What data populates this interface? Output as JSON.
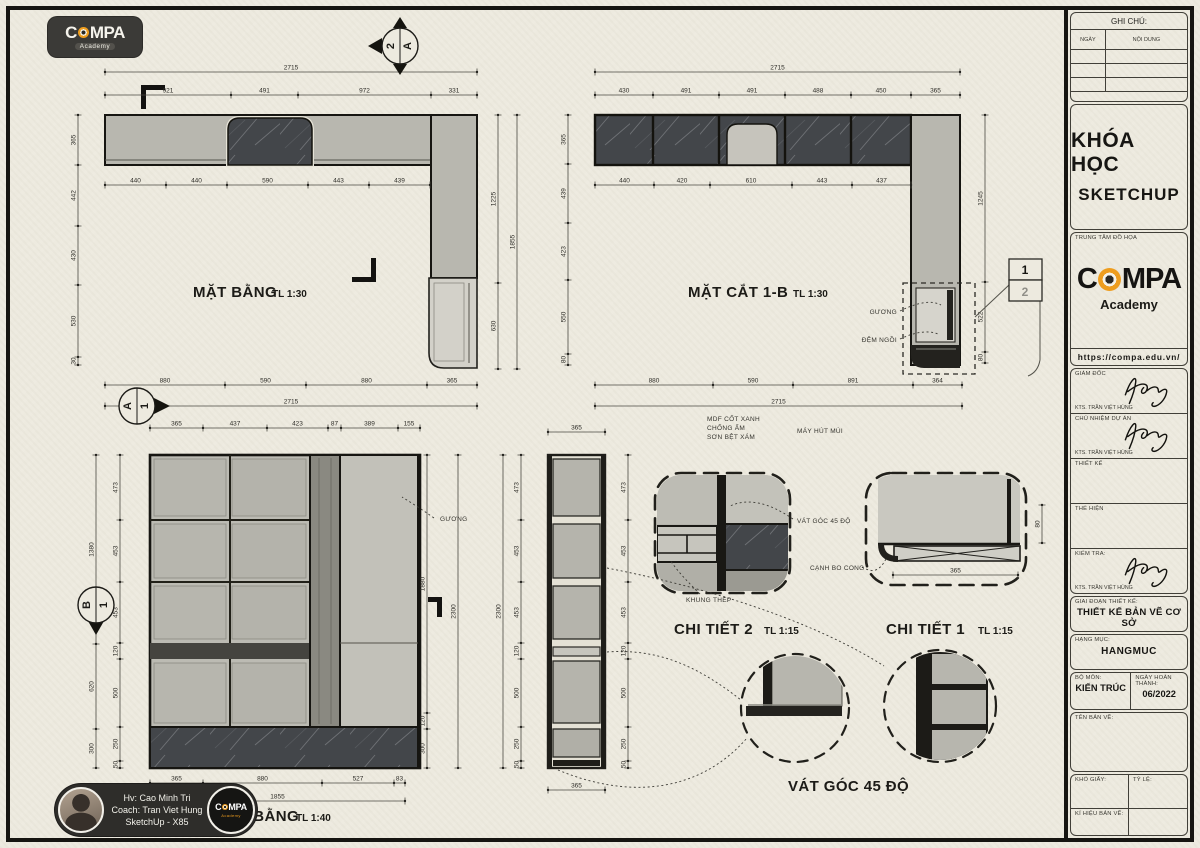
{
  "logo": {
    "brand_pre": "C",
    "brand_post": "MPA",
    "sub": "Academy"
  },
  "credit": {
    "line1": "Hv: Cao Minh Tri",
    "line2": "Coach: Tran Viet Hung",
    "line3": "SketchUp - X85"
  },
  "north": {
    "left": "2",
    "right": "A"
  },
  "plan": {
    "title": "MẶT BẰNG",
    "scale": "TL 1:30",
    "total_top": "2715",
    "top": [
      "921",
      "491",
      "972",
      "331"
    ],
    "inner": [
      "440",
      "440",
      "590",
      "443",
      "439"
    ],
    "left": [
      "365",
      "442",
      "430",
      "530",
      "30"
    ],
    "right_inner": [
      "1225",
      "630"
    ],
    "right_outer": "1855",
    "bottom": [
      "880",
      "590",
      "880",
      "365"
    ],
    "total_bottom": "2715",
    "marker_letter": "A",
    "marker_num": "1"
  },
  "section": {
    "title": "MẶT CẮT 1-B",
    "scale": "TL 1:30",
    "total_top": "2715",
    "top": [
      "430",
      "491",
      "491",
      "488",
      "450",
      "365"
    ],
    "inner": [
      "440",
      "420",
      "610",
      "443",
      "437"
    ],
    "left": [
      "365",
      "439",
      "423",
      "550",
      "80"
    ],
    "right": [
      "1245",
      "522",
      "80"
    ],
    "bottom": [
      "880",
      "590",
      "891",
      "364"
    ],
    "total_bottom": "2715",
    "callout_1": "1",
    "callout_2": "2",
    "ann_mirror": "GƯƠNG",
    "ann_cushion": "ĐỆM NGỒI",
    "note_mdf_1": "MDF CỐT XANH",
    "note_mdf_2": "CHỐNG ẨM",
    "note_mdf_3": "SƠN BỆT XÁM",
    "note_hood": "MÁY HÚT MÙI"
  },
  "elevation": {
    "title": "MẶT BẰNG",
    "scale": "TL 1:40",
    "top": [
      "365",
      "437",
      "423",
      "87",
      "389",
      "155"
    ],
    "left_outer": [
      "1380",
      "620",
      "300"
    ],
    "left_inner": [
      "473",
      "453",
      "453",
      "120",
      "500",
      "250",
      "50"
    ],
    "right_inner": [
      "1880",
      "120",
      "300"
    ],
    "right_outer": "2300",
    "bottom": [
      "365",
      "880",
      "527",
      "83"
    ],
    "total_bottom": "1855",
    "ann_mirror": "GƯƠNG",
    "marker_letter": "B",
    "marker_num": "1"
  },
  "strip": {
    "top_width": "365",
    "bottom_width": "365",
    "outer": "2300",
    "left": [
      "473",
      "453",
      "453",
      "120",
      "500",
      "250",
      "50"
    ],
    "right": [
      "473",
      "453",
      "453",
      "120",
      "500",
      "250",
      "50"
    ]
  },
  "detail2": {
    "title": "CHI TIẾT 2",
    "scale": "TL 1:15",
    "ann_chamfer": "VÁT GÓC 45 ĐỘ",
    "ann_frame": "KHUNG THÉP"
  },
  "detail1": {
    "title": "CHI TIẾT 1",
    "scale": "TL 1:15",
    "ann_round": "CẠNH BO CONG",
    "width": "365",
    "side": "80"
  },
  "chamfer_label": "VÁT GÓC 45 ĐỘ",
  "title_block": {
    "notes_title": "GHI CHÚ:",
    "col_date": "NGÀY",
    "col_content": "NỘI DUNG",
    "course_1": "KHÓA HỌC",
    "course_2": "SKETCHUP",
    "center_label": "TRUNG TÂM ĐỒ HỌA",
    "brand_pre": "C",
    "brand_post": "MPA",
    "brand_sub": "Academy",
    "website": "https://compa.edu.vn/",
    "role_1": "GIÁM ĐỐC",
    "role_1_name": "KTS. TRẦN VIỆT HÙNG",
    "role_2": "CHỦ NHIỆM DỰ ÁN",
    "role_2_name": "KTS. TRẦN VIỆT HÙNG",
    "role_3": "THIẾT KẾ",
    "role_4": "THỂ HIỆN",
    "role_5": "KIỂM TRA:",
    "role_5_name": "KTS. TRẦN VIỆT HÙNG",
    "stage_label": "GIAI ĐOẠN THIẾT KẾ:",
    "stage_value": "THIẾT KẾ BẢN VẼ CƠ SỞ",
    "category_label": "HẠNG MỤC:",
    "category_value": "HANGMUC",
    "dept_label": "BỘ MÔN:",
    "dept_value": "KIẾN TRÚC",
    "date_label": "NGÀY HOÀN THÀNH:",
    "date_value": "06/2022",
    "dwg_name_label": "TÊN BẢN VẼ:",
    "paper_label": "KHỔ GIẤY:",
    "scale_label": "TỶ LỆ:",
    "code_label": "KÍ HIỆU BẢN VẼ:"
  }
}
